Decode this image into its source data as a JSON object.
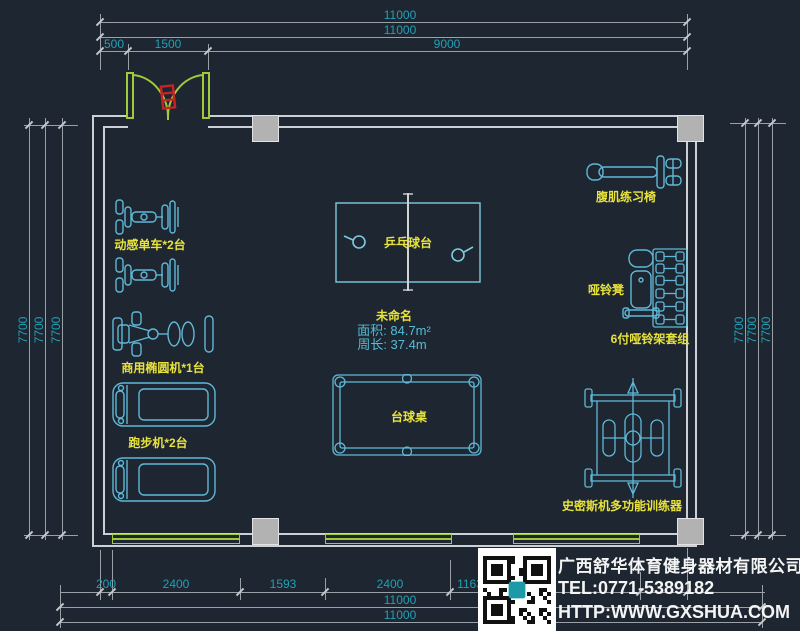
{
  "drawing_type": "gym-floor-plan",
  "colors": {
    "background": "#1d2631",
    "wall": "#ccd0d4",
    "dimension_line": "#9aa0a6",
    "dimension_text": "#21a0b5",
    "equipment_cyan": "#5fb9d7",
    "label_yellow": "#e8e33c",
    "door_window_green": "#9fcb3b",
    "door_symbol_red": "#c62424",
    "column_gray": "#b2b2b2",
    "company_text_white": "#f4f4f4"
  },
  "dims": {
    "top": [
      "11000",
      "11000",
      "500",
      "1500",
      "9000"
    ],
    "left": [
      "7700",
      "7700",
      "7700"
    ],
    "right": [
      "7700",
      "7700",
      "7700"
    ],
    "bottom": [
      "200",
      "2400",
      "1593",
      "2400",
      "1163",
      "11000",
      "11000"
    ]
  },
  "room_info": {
    "name": "未命名",
    "area": "面积: 84.7m²",
    "perimeter": "周长: 37.4m"
  },
  "labels": {
    "spin_bike": "动感单车*2台",
    "elliptical": "商用椭圆机*1台",
    "treadmill": "跑步机*2台",
    "pingpong": "乒乓球台",
    "billiard": "台球桌",
    "ab_chair": "腹肌练习椅",
    "db_bench": "哑铃凳",
    "db_rack": "6付哑铃架套组",
    "smith": "史密斯机多功能训练器"
  },
  "company": {
    "name": "广西舒华体育健身器材有限公司",
    "tel": "TEL:0771-5389182",
    "website": "HTTP:WWW.GXSHUA.COM"
  }
}
